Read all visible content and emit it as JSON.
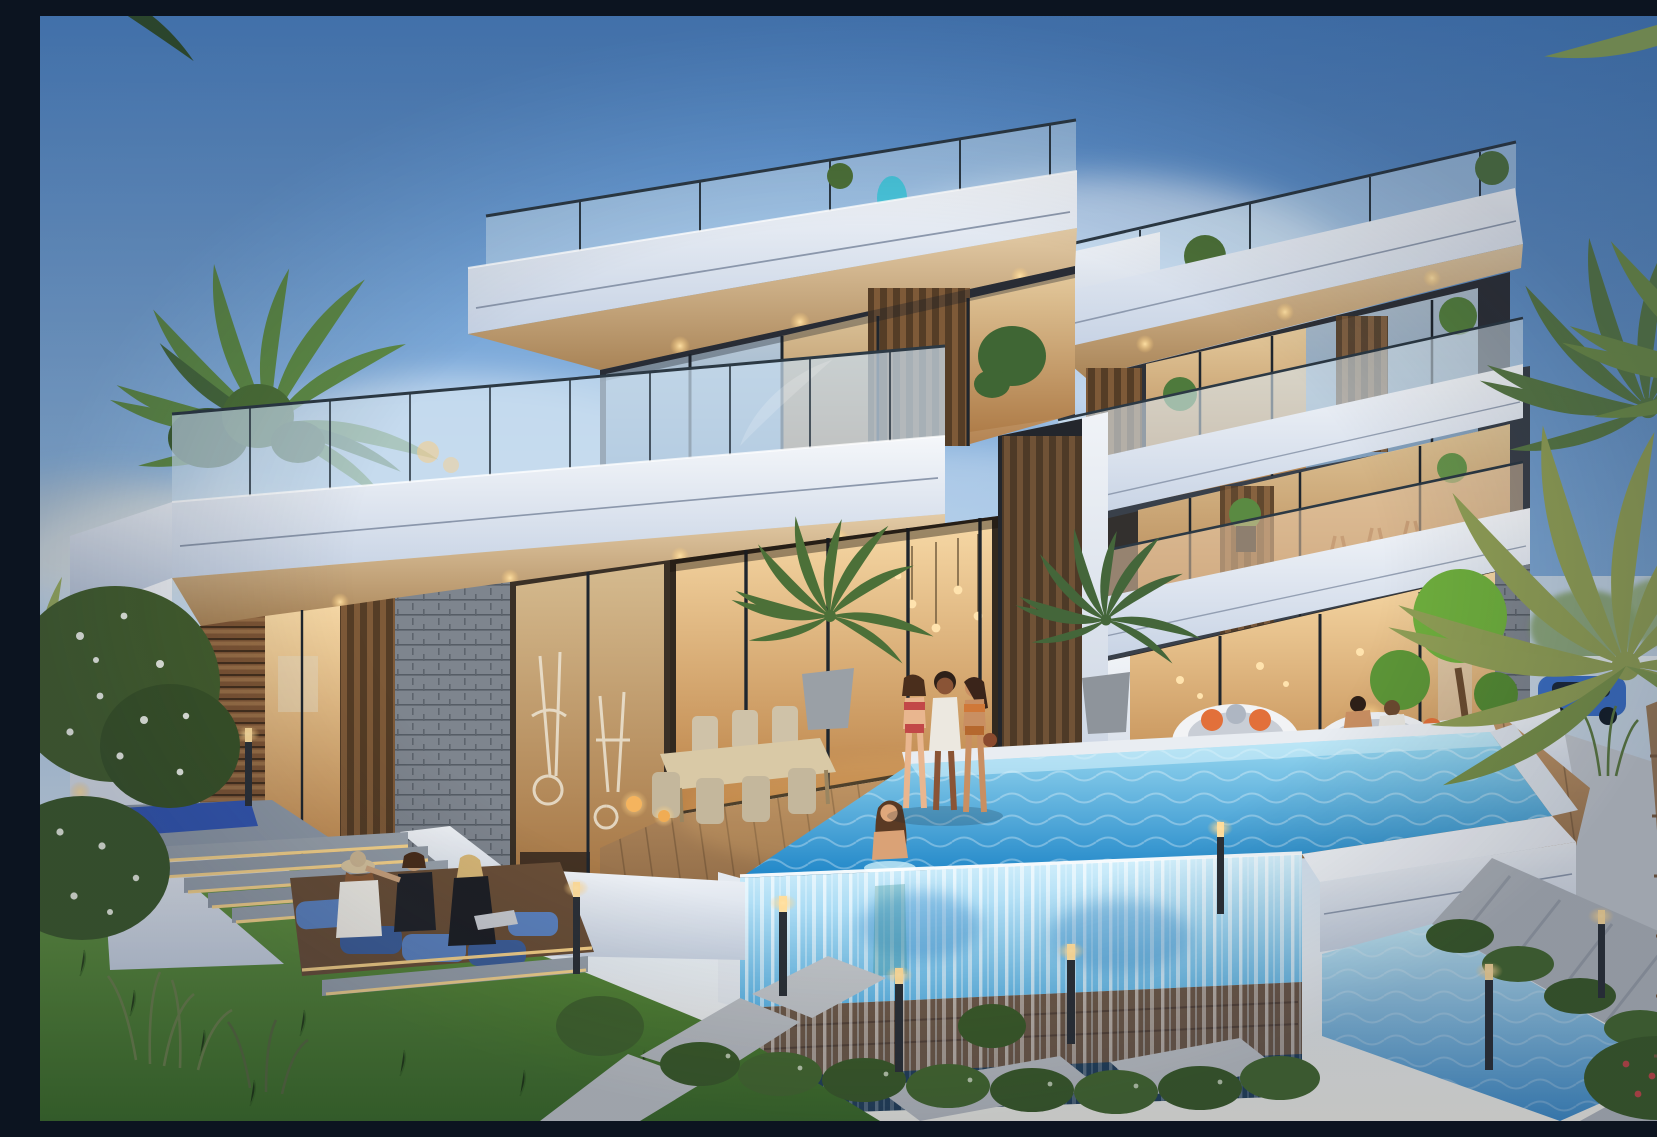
{
  "scene": {
    "title": "Modern luxury villa at dusk",
    "description": "Photorealistic dusk rendering of a two-volume modern white villa with cantilevered slabs, glass balustrades, warm-lit interiors, an infinity pool with a transparent acrylic waterfall wall, landscaped gardens, palm trees, wicker daybeds and people relaxing.",
    "time_of_day": "dusk",
    "style": "architectural exterior rendering"
  },
  "palette": {
    "sky_top": "#4e86c8",
    "sky_mid": "#9cc2e6",
    "sky_low": "#e9eff5",
    "slab_light": "#f5f7fa",
    "slab_shadow": "#c6d2e4",
    "soffit_warm": "#e3cba6",
    "glass_warm": "#f7d9a6",
    "glass_cool": "#cfe2f2",
    "wood_slat": "#7e5a38",
    "stone": "#7e858e",
    "deck_light": "#c59a6c",
    "deck_deep": "#95704a",
    "pool_light": "#9fdcf2",
    "pool_deep": "#1f86c8",
    "acrylic_light": "#d6f1fc",
    "acrylic_deep": "#5fb6e6",
    "lawn_light": "#6a9a44",
    "lawn_deep": "#3c6b28",
    "hedge": "#3c5c2a",
    "paver": "#b6bac0",
    "led": "#ffd98c",
    "lantern": "#ffc87a",
    "teal_accent": "#3fc3d8",
    "yoga_mat": "#3457b2",
    "cushion_blue": "#5d83c0",
    "pillow_orange": "#e2703a",
    "car_blue": "#3c6fc4",
    "white_bloom": "#eef2e8",
    "rail_metal": "#2c3944"
  },
  "elements": {
    "buildings": [
      {
        "id": "left-villa-volume",
        "features": [
          "cantilevered roof slab",
          "rooftop glass railing with teal glass sculpture",
          "terrace glass balustrade",
          "wood slat cladding",
          "stacked stone pillar",
          "home gym behind glazing",
          "warm recessed soffit downlights"
        ]
      },
      {
        "id": "right-villa-volume",
        "features": [
          "three storeys",
          "balconies with glass railings",
          "outdoor bar chairs on balcony",
          "vertical louvre screens",
          "planters with greenery",
          "floor-to-ceiling warm-lit glazing"
        ]
      }
    ],
    "pool": {
      "type": "infinity pool",
      "features": [
        "transparent acrylic front wall",
        "cascading waterfall edge",
        "white coping walls",
        "lit lower reflecting channel"
      ]
    },
    "garden": [
      "manicured lawn",
      "granite steps with LED strip lighting",
      "sunken lounge pit with blue cushions",
      "white flowering shrubs",
      "ornamental grasses",
      "boxwood hedges",
      "paver pathways",
      "bollard path lights",
      "topiary trees in white planter",
      "glowing wicker lanterns"
    ],
    "furniture": [
      "outdoor dining table with chairs",
      "round wicker daybeds with orange and grey pillows",
      "potted palms"
    ],
    "people": [
      {
        "id": "yoga-woman",
        "activity": "stretching on a blue yoga mat",
        "location": "upper left terrace"
      },
      {
        "id": "lounge-woman-hat",
        "activity": "seated, wearing a sun hat",
        "location": "sunken lounge"
      },
      {
        "id": "lounge-woman-center",
        "activity": "seated, arm outstretched",
        "location": "sunken lounge"
      },
      {
        "id": "lounge-woman-laptop",
        "activity": "seated with a silver laptop",
        "location": "sunken lounge"
      },
      {
        "id": "walker-red-bikini",
        "activity": "walking poolside",
        "location": "terrace"
      },
      {
        "id": "walker-white-coverup",
        "activity": "walking poolside",
        "location": "terrace"
      },
      {
        "id": "walker-orange-bikini",
        "activity": "walking poolside",
        "location": "terrace"
      },
      {
        "id": "swimmer",
        "activity": "standing in the pool",
        "location": "infinity pool corner"
      },
      {
        "id": "daybed-pair",
        "activity": "two people relaxing on a wicker daybed",
        "location": "poolside right"
      }
    ],
    "vehicle": {
      "id": "parked-car",
      "color_name": "blue",
      "location": "far right background"
    }
  }
}
